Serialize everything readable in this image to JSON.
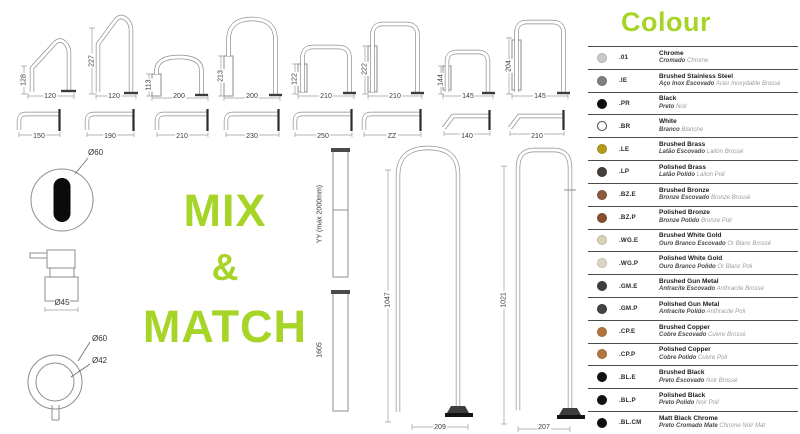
{
  "headline": {
    "line1": "MIX",
    "line2": "&",
    "line3": "MATCH",
    "color": "#a6d427"
  },
  "spouts_row1": [
    {
      "height": "128",
      "width": "120"
    },
    {
      "height": "227",
      "width": "120"
    },
    {
      "height": "113",
      "width": "200"
    },
    {
      "height": "213",
      "width": "200"
    },
    {
      "height": "122",
      "width": "210"
    },
    {
      "height": "222",
      "width": "210"
    },
    {
      "height": "144",
      "width": "145"
    },
    {
      "height": "204",
      "width": "145"
    }
  ],
  "wall_spouts": [
    {
      "length": "150"
    },
    {
      "length": "190"
    },
    {
      "length": "210"
    },
    {
      "length": "230"
    },
    {
      "length": "250"
    },
    {
      "length": "ZZ"
    },
    {
      "length": "140"
    },
    {
      "length": "210"
    }
  ],
  "handles": {
    "top_knob_diameter": "Ø60",
    "mixer_diameter": "Ø45",
    "knob_outer_diameter": "Ø60",
    "knob_inner_diameter": "Ø42"
  },
  "risers": [
    {
      "label": "YY (max 2000mm)"
    },
    {
      "label": "1605"
    }
  ],
  "floor_spouts": [
    {
      "height": "1047",
      "width": "209"
    },
    {
      "height": "1021",
      "width": "207"
    }
  ],
  "colour": {
    "title": "Colour",
    "accent": "#a6d427",
    "items": [
      {
        "code": ".01",
        "name": "Chrome",
        "pt": "Cromado",
        "fr": "Chrome",
        "dot": "#c9c9c9",
        "ring": "#b2b2b2"
      },
      {
        "code": ".IE",
        "name": "Brushed Stainless Steel",
        "pt": "Aço Inox Escovado",
        "fr": "Acier Inoxydable Brossé",
        "dot": "#7f7f7f",
        "ring": "#6e6e6e"
      },
      {
        "code": ".PR",
        "name": "Black",
        "pt": "Preto",
        "fr": "Noir",
        "dot": "#0d0d0d",
        "ring": "#0d0d0d"
      },
      {
        "code": ".BR",
        "name": "White",
        "pt": "Branco",
        "fr": "Blanche",
        "dot": "#ffffff",
        "ring": "#444444"
      },
      {
        "code": ".LE",
        "name": "Brushed Brass",
        "pt": "Latão Escovado",
        "fr": "Laiton Brossé",
        "dot": "#b49b1e",
        "ring": "#a08a18"
      },
      {
        "code": ".LP",
        "name": "Polished Brass",
        "pt": "Latão Polido",
        "fr": "Laiton Poli",
        "dot": "#46403a",
        "ring": "#38332e"
      },
      {
        "code": ".BZ.E",
        "name": "Brushed Bronze",
        "pt": "Bronze Escovado",
        "fr": "Bronze Brossé",
        "dot": "#8a5a3b",
        "ring": "#7a4e32"
      },
      {
        "code": ".BZ.P",
        "name": "Polished Bronze",
        "pt": "Bronze Polido",
        "fr": "Bronze Poli",
        "dot": "#8a4f2e",
        "ring": "#7a4527"
      },
      {
        "code": ".WG.E",
        "name": "Brushed White Gold",
        "pt": "Ouro Branco Escovado",
        "fr": "Or Blanc Brossé",
        "dot": "#d9d0bc",
        "ring": "#c0b7a2"
      },
      {
        "code": ".WG.P",
        "name": "Polished White Gold",
        "pt": "Ouro Branco Polido",
        "fr": "Or Blanc Poli",
        "dot": "#ddd5c3",
        "ring": "#c4bca9"
      },
      {
        "code": ".GM.E",
        "name": "Brushed Gun Metal",
        "pt": "Antracite Escovado",
        "fr": "Anthracite Brossé",
        "dot": "#3f3f41",
        "ring": "#343436"
      },
      {
        "code": ".GM.P",
        "name": "Polished Gun Metal",
        "pt": "Antracite Polido",
        "fr": "Anthracite Poli",
        "dot": "#434345",
        "ring": "#363638"
      },
      {
        "code": ".CP.E",
        "name": "Brushed Copper",
        "pt": "Cobre Escovado",
        "fr": "Cuivre Brossé",
        "dot": "#b0763d",
        "ring": "#9e6933"
      },
      {
        "code": ".CP.P",
        "name": "Polished Copper",
        "pt": "Cobre Polido",
        "fr": "Cuivre Poli",
        "dot": "#b1773e",
        "ring": "#9e6933"
      },
      {
        "code": ".BL.E",
        "name": "Brushed Black",
        "pt": "Preto Escovado",
        "fr": "Noir Brossé",
        "dot": "#111111",
        "ring": "#111111"
      },
      {
        "code": ".BL.P",
        "name": "Polished Black",
        "pt": "Preto Polido",
        "fr": "Noir Poli",
        "dot": "#101010",
        "ring": "#101010"
      },
      {
        "code": ".BL.CM",
        "name": "Matt Black Chrome",
        "pt": "Preto Cromado Mate",
        "fr": "Chrome Noir Mat",
        "dot": "#0e0e0e",
        "ring": "#0e0e0e"
      }
    ]
  }
}
